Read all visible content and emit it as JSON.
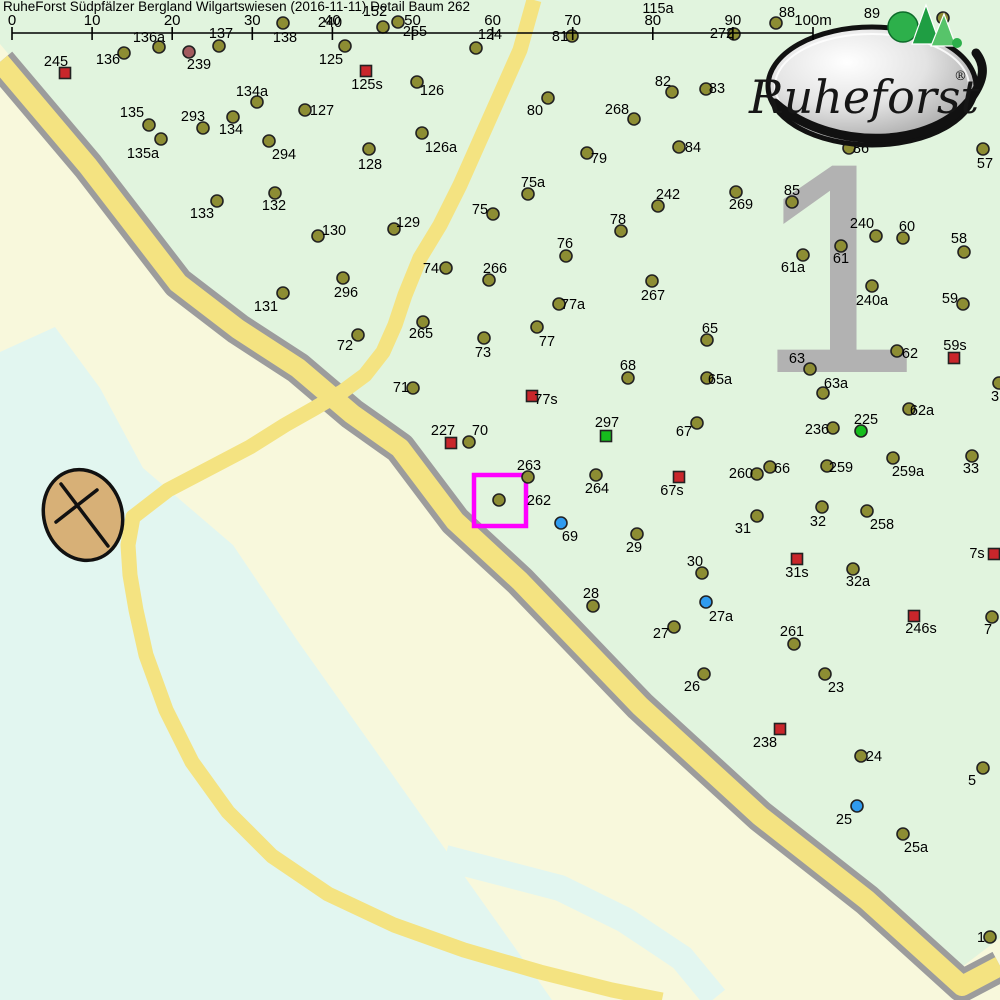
{
  "title": "RuheForst Südpfälzer Bergland Wilgartswiesen (2016-11-11) Detail  Baum 262",
  "zone_number": "1",
  "logo": {
    "brand": "Ruheforst",
    "registered": "®"
  },
  "scale_bar": {
    "ticks": [
      "0",
      "10",
      "20",
      "30",
      "40",
      "50",
      "60",
      "70",
      "80",
      "90",
      "100m"
    ],
    "x_start": 12,
    "x_end": 813,
    "y": 33
  },
  "selection": {
    "tree": "262",
    "x": 474,
    "y": 475,
    "w": 52,
    "h": 51
  },
  "colors": {
    "olive": "#8d8d33",
    "olive_stroke": "#222222",
    "red": "#c9262b",
    "green": "#16bd1d",
    "blue": "#2f9bef",
    "dark_red": "#a25a5e",
    "magenta": "#ff00ff",
    "forest": "#e1f4de",
    "meadow": "#f8f8dc",
    "water": "#e2f6f0",
    "road_fill": "#f4e381",
    "road_edge": "#9c9c9c",
    "zone_gray": "#b2b2b2",
    "compass_fill": "#d7b077",
    "label_text": "#000000",
    "logo_green": "#2db04b"
  },
  "map_data": {
    "type": "map",
    "marker_types": {
      "o": "tree",
      "d": "tree-old",
      "r": "memorial-square-red",
      "gs": "memorial-square-green",
      "gd": "tree-green",
      "b": "tree-blue"
    },
    "markers": [
      {
        "i": "245",
        "t": "r",
        "x": 65,
        "y": 73,
        "lx": 56,
        "ly": 61
      },
      {
        "i": "136",
        "t": "o",
        "x": 124,
        "y": 53,
        "lx": 108,
        "ly": 59
      },
      {
        "i": "136a",
        "t": "o",
        "x": 159,
        "y": 47,
        "lx": 149,
        "ly": 37
      },
      {
        "i": "239",
        "t": "d",
        "x": 189,
        "y": 52,
        "lx": 199,
        "ly": 64
      },
      {
        "i": "137",
        "t": "o",
        "x": 219,
        "y": 46,
        "lx": 221,
        "ly": 33
      },
      {
        "i": "138",
        "t": "o",
        "x": 283,
        "y": 23,
        "lx": 285,
        "ly": 37
      },
      {
        "i": "125",
        "t": "o",
        "x": 345,
        "y": 46,
        "lx": 331,
        "ly": 59
      },
      {
        "i": "240",
        "t": "o",
        "lx": 330,
        "ly": 22
      },
      {
        "i": "152",
        "t": "o",
        "x": 383,
        "y": 27,
        "lx": 375,
        "ly": 11
      },
      {
        "i": "255",
        "t": "o",
        "x": 398,
        "y": 22,
        "lx": 415,
        "ly": 31
      },
      {
        "i": "124",
        "t": "o",
        "x": 476,
        "y": 48,
        "lx": 490,
        "ly": 34
      },
      {
        "i": "81",
        "t": "o",
        "x": 572,
        "y": 36,
        "lx": 560,
        "ly": 36
      },
      {
        "i": "115a",
        "t": "o",
        "lx": 658,
        "ly": 8
      },
      {
        "i": "272",
        "t": "o",
        "x": 734,
        "y": 34,
        "lx": 722,
        "ly": 33
      },
      {
        "i": "88",
        "t": "o",
        "x": 776,
        "y": 23,
        "lx": 787,
        "ly": 12
      },
      {
        "i": "89",
        "t": "o",
        "lx": 872,
        "ly": 13
      },
      {
        "i": "",
        "t": "o",
        "x": 943,
        "y": 18
      },
      {
        "i": "125s",
        "t": "r",
        "x": 366,
        "y": 71,
        "lx": 367,
        "ly": 84
      },
      {
        "i": "126",
        "t": "o",
        "x": 417,
        "y": 82,
        "lx": 432,
        "ly": 90
      },
      {
        "i": "82",
        "t": "o",
        "x": 672,
        "y": 92,
        "lx": 663,
        "ly": 81
      },
      {
        "i": "80",
        "t": "o",
        "x": 548,
        "y": 98,
        "lx": 535,
        "ly": 110
      },
      {
        "i": "268",
        "t": "o",
        "x": 634,
        "y": 119,
        "lx": 617,
        "ly": 109
      },
      {
        "i": "83",
        "t": "o",
        "x": 706,
        "y": 89,
        "lx": 717,
        "ly": 88
      },
      {
        "i": "134a",
        "t": "o",
        "x": 257,
        "y": 102,
        "lx": 252,
        "ly": 91
      },
      {
        "i": "127",
        "t": "o",
        "x": 305,
        "y": 110,
        "lx": 322,
        "ly": 110
      },
      {
        "i": "135",
        "t": "o",
        "x": 149,
        "y": 125,
        "lx": 132,
        "ly": 112
      },
      {
        "i": "293",
        "t": "o",
        "x": 203,
        "y": 128,
        "lx": 193,
        "ly": 116
      },
      {
        "i": "134",
        "t": "o",
        "x": 233,
        "y": 117,
        "lx": 231,
        "ly": 129
      },
      {
        "i": "294",
        "t": "o",
        "x": 269,
        "y": 141,
        "lx": 284,
        "ly": 154
      },
      {
        "i": "135a",
        "t": "o",
        "x": 161,
        "y": 139,
        "lx": 143,
        "ly": 153
      },
      {
        "i": "84",
        "t": "o",
        "x": 679,
        "y": 147,
        "lx": 693,
        "ly": 147
      },
      {
        "i": "79",
        "t": "o",
        "x": 587,
        "y": 153,
        "lx": 599,
        "ly": 158
      },
      {
        "i": "86",
        "t": "o",
        "x": 849,
        "y": 148,
        "lx": 861,
        "ly": 148
      },
      {
        "i": "57",
        "t": "o",
        "x": 983,
        "y": 149,
        "lx": 985,
        "ly": 163
      },
      {
        "i": "126a",
        "t": "o",
        "x": 422,
        "y": 133,
        "lx": 441,
        "ly": 147
      },
      {
        "i": "128",
        "t": "o",
        "x": 369,
        "y": 149,
        "lx": 370,
        "ly": 164
      },
      {
        "i": "85",
        "t": "o",
        "x": 792,
        "y": 202,
        "lx": 792,
        "ly": 190
      },
      {
        "i": "133",
        "t": "o",
        "x": 217,
        "y": 201,
        "lx": 202,
        "ly": 213
      },
      {
        "i": "132",
        "t": "o",
        "x": 275,
        "y": 193,
        "lx": 274,
        "ly": 205
      },
      {
        "i": "269",
        "t": "o",
        "x": 736,
        "y": 192,
        "lx": 741,
        "ly": 204
      },
      {
        "i": "242",
        "t": "o",
        "x": 658,
        "y": 206,
        "lx": 668,
        "ly": 194
      },
      {
        "i": "75a",
        "t": "o",
        "x": 528,
        "y": 194,
        "lx": 533,
        "ly": 182
      },
      {
        "i": "75",
        "t": "o",
        "x": 493,
        "y": 214,
        "lx": 480,
        "ly": 209
      },
      {
        "i": "76",
        "t": "o",
        "x": 566,
        "y": 256,
        "lx": 565,
        "ly": 243
      },
      {
        "i": "78",
        "t": "o",
        "x": 621,
        "y": 231,
        "lx": 618,
        "ly": 219
      },
      {
        "i": "129",
        "t": "o",
        "x": 394,
        "y": 229,
        "lx": 408,
        "ly": 222
      },
      {
        "i": "130",
        "t": "o",
        "x": 318,
        "y": 236,
        "lx": 334,
        "ly": 230
      },
      {
        "i": "240",
        "t": "o",
        "x": 876,
        "y": 236,
        "lx": 862,
        "ly": 223
      },
      {
        "i": "60",
        "t": "o",
        "x": 903,
        "y": 238,
        "lx": 907,
        "ly": 226
      },
      {
        "i": "61",
        "t": "o",
        "x": 841,
        "y": 246,
        "lx": 841,
        "ly": 258
      },
      {
        "i": "61a",
        "t": "o",
        "x": 803,
        "y": 255,
        "lx": 793,
        "ly": 267
      },
      {
        "i": "58",
        "t": "o",
        "x": 964,
        "y": 252,
        "lx": 959,
        "ly": 238
      },
      {
        "i": "266",
        "t": "o",
        "x": 489,
        "y": 280,
        "lx": 495,
        "ly": 268
      },
      {
        "i": "74",
        "t": "o",
        "x": 446,
        "y": 268,
        "lx": 431,
        "ly": 268
      },
      {
        "i": "296",
        "t": "o",
        "x": 343,
        "y": 278,
        "lx": 346,
        "ly": 292
      },
      {
        "i": "267",
        "t": "o",
        "x": 652,
        "y": 281,
        "lx": 653,
        "ly": 295
      },
      {
        "i": "77a",
        "t": "o",
        "x": 559,
        "y": 304,
        "lx": 573,
        "ly": 304
      },
      {
        "i": "240a",
        "t": "o",
        "x": 872,
        "y": 286,
        "lx": 872,
        "ly": 300
      },
      {
        "i": "59",
        "t": "o",
        "x": 963,
        "y": 304,
        "lx": 950,
        "ly": 298
      },
      {
        "i": "131",
        "t": "o",
        "x": 283,
        "y": 293,
        "lx": 266,
        "ly": 306
      },
      {
        "i": "72",
        "t": "o",
        "x": 358,
        "y": 335,
        "lx": 345,
        "ly": 345
      },
      {
        "i": "265",
        "t": "o",
        "x": 423,
        "y": 322,
        "lx": 421,
        "ly": 333
      },
      {
        "i": "77",
        "t": "o",
        "x": 537,
        "y": 327,
        "lx": 547,
        "ly": 341
      },
      {
        "i": "73",
        "t": "o",
        "x": 484,
        "y": 338,
        "lx": 483,
        "ly": 352
      },
      {
        "i": "65",
        "t": "o",
        "x": 707,
        "y": 340,
        "lx": 710,
        "ly": 328
      },
      {
        "i": "68",
        "t": "o",
        "x": 628,
        "y": 378,
        "lx": 628,
        "ly": 365
      },
      {
        "i": "63",
        "t": "o",
        "x": 810,
        "y": 369,
        "lx": 797,
        "ly": 358
      },
      {
        "i": "63a",
        "t": "o",
        "x": 823,
        "y": 393,
        "lx": 836,
        "ly": 383
      },
      {
        "i": "62",
        "t": "o",
        "x": 897,
        "y": 351,
        "lx": 910,
        "ly": 353
      },
      {
        "i": "59s",
        "t": "r",
        "x": 954,
        "y": 358,
        "lx": 955,
        "ly": 345
      },
      {
        "i": "71",
        "t": "o",
        "x": 413,
        "y": 388,
        "lx": 401,
        "ly": 387
      },
      {
        "i": "77s",
        "t": "r",
        "x": 532,
        "y": 396,
        "lx": 546,
        "ly": 399
      },
      {
        "i": "65a",
        "t": "o",
        "x": 707,
        "y": 378,
        "lx": 720,
        "ly": 379
      },
      {
        "i": "67",
        "t": "o",
        "x": 697,
        "y": 423,
        "lx": 684,
        "ly": 431
      },
      {
        "i": "297",
        "t": "gs",
        "x": 606,
        "y": 436,
        "lx": 607,
        "ly": 422
      },
      {
        "i": "62a",
        "t": "o",
        "x": 909,
        "y": 409,
        "lx": 922,
        "ly": 410
      },
      {
        "i": "225",
        "t": "gd",
        "x": 861,
        "y": 431,
        "lx": 866,
        "ly": 419
      },
      {
        "i": "236",
        "t": "o",
        "x": 833,
        "y": 428,
        "lx": 817,
        "ly": 429
      },
      {
        "i": "227",
        "t": "r",
        "x": 451,
        "y": 443,
        "lx": 443,
        "ly": 430
      },
      {
        "i": "70",
        "t": "o",
        "x": 469,
        "y": 442,
        "lx": 480,
        "ly": 430
      },
      {
        "i": "263",
        "t": "o",
        "x": 528,
        "y": 477,
        "lx": 529,
        "ly": 465
      },
      {
        "i": "264",
        "t": "o",
        "x": 596,
        "y": 475,
        "lx": 597,
        "ly": 488
      },
      {
        "i": "67s",
        "t": "r",
        "x": 679,
        "y": 477,
        "lx": 672,
        "ly": 490
      },
      {
        "i": "260",
        "t": "o",
        "x": 757,
        "y": 474,
        "lx": 741,
        "ly": 473
      },
      {
        "i": "66",
        "t": "o",
        "x": 770,
        "y": 467,
        "lx": 782,
        "ly": 468
      },
      {
        "i": "259",
        "t": "o",
        "x": 827,
        "y": 466,
        "lx": 841,
        "ly": 467
      },
      {
        "i": "259a",
        "t": "o",
        "x": 893,
        "y": 458,
        "lx": 908,
        "ly": 471
      },
      {
        "i": "33",
        "t": "o",
        "x": 972,
        "y": 456,
        "lx": 971,
        "ly": 468
      },
      {
        "i": "3",
        "t": "o",
        "x": 999,
        "y": 383,
        "lx": 995,
        "ly": 396
      },
      {
        "i": "262",
        "t": "o",
        "x": 499,
        "y": 500,
        "lx": 539,
        "ly": 500
      },
      {
        "i": "69",
        "t": "b",
        "x": 561,
        "y": 523,
        "lx": 570,
        "ly": 536
      },
      {
        "i": "29",
        "t": "o",
        "x": 637,
        "y": 534,
        "lx": 634,
        "ly": 547
      },
      {
        "i": "31",
        "t": "o",
        "x": 757,
        "y": 516,
        "lx": 743,
        "ly": 528
      },
      {
        "i": "32",
        "t": "o",
        "x": 822,
        "y": 507,
        "lx": 818,
        "ly": 521
      },
      {
        "i": "258",
        "t": "o",
        "x": 867,
        "y": 511,
        "lx": 882,
        "ly": 524
      },
      {
        "i": "30",
        "t": "o",
        "x": 702,
        "y": 573,
        "lx": 695,
        "ly": 561
      },
      {
        "i": "28",
        "t": "o",
        "x": 593,
        "y": 606,
        "lx": 591,
        "ly": 593
      },
      {
        "i": "27a",
        "t": "b",
        "x": 706,
        "y": 602,
        "lx": 721,
        "ly": 616
      },
      {
        "i": "27",
        "t": "o",
        "x": 674,
        "y": 627,
        "lx": 661,
        "ly": 633
      },
      {
        "i": "31s",
        "t": "r",
        "x": 797,
        "y": 559,
        "lx": 797,
        "ly": 572
      },
      {
        "i": "32a",
        "t": "o",
        "x": 853,
        "y": 569,
        "lx": 858,
        "ly": 581
      },
      {
        "i": "7s",
        "t": "r",
        "x": 994,
        "y": 554,
        "lx": 977,
        "ly": 553
      },
      {
        "i": "246s",
        "t": "r",
        "x": 914,
        "y": 616,
        "lx": 921,
        "ly": 628
      },
      {
        "i": "7",
        "t": "o",
        "x": 992,
        "y": 617,
        "lx": 988,
        "ly": 629
      },
      {
        "i": "261",
        "t": "o",
        "x": 794,
        "y": 644,
        "lx": 792,
        "ly": 631
      },
      {
        "i": "26",
        "t": "o",
        "x": 704,
        "y": 674,
        "lx": 692,
        "ly": 686
      },
      {
        "i": "23",
        "t": "o",
        "x": 825,
        "y": 674,
        "lx": 836,
        "ly": 687
      },
      {
        "i": "238",
        "t": "r",
        "x": 780,
        "y": 729,
        "lx": 765,
        "ly": 742
      },
      {
        "i": "24",
        "t": "o",
        "x": 861,
        "y": 756,
        "lx": 874,
        "ly": 756
      },
      {
        "i": "5",
        "t": "o",
        "x": 983,
        "y": 768,
        "lx": 972,
        "ly": 780
      },
      {
        "i": "25",
        "t": "b",
        "x": 857,
        "y": 806,
        "lx": 844,
        "ly": 819
      },
      {
        "i": "25a",
        "t": "o",
        "x": 903,
        "y": 834,
        "lx": 916,
        "ly": 847
      },
      {
        "i": "1",
        "t": "o",
        "x": 990,
        "y": 937,
        "lx": 981,
        "ly": 937
      }
    ]
  }
}
